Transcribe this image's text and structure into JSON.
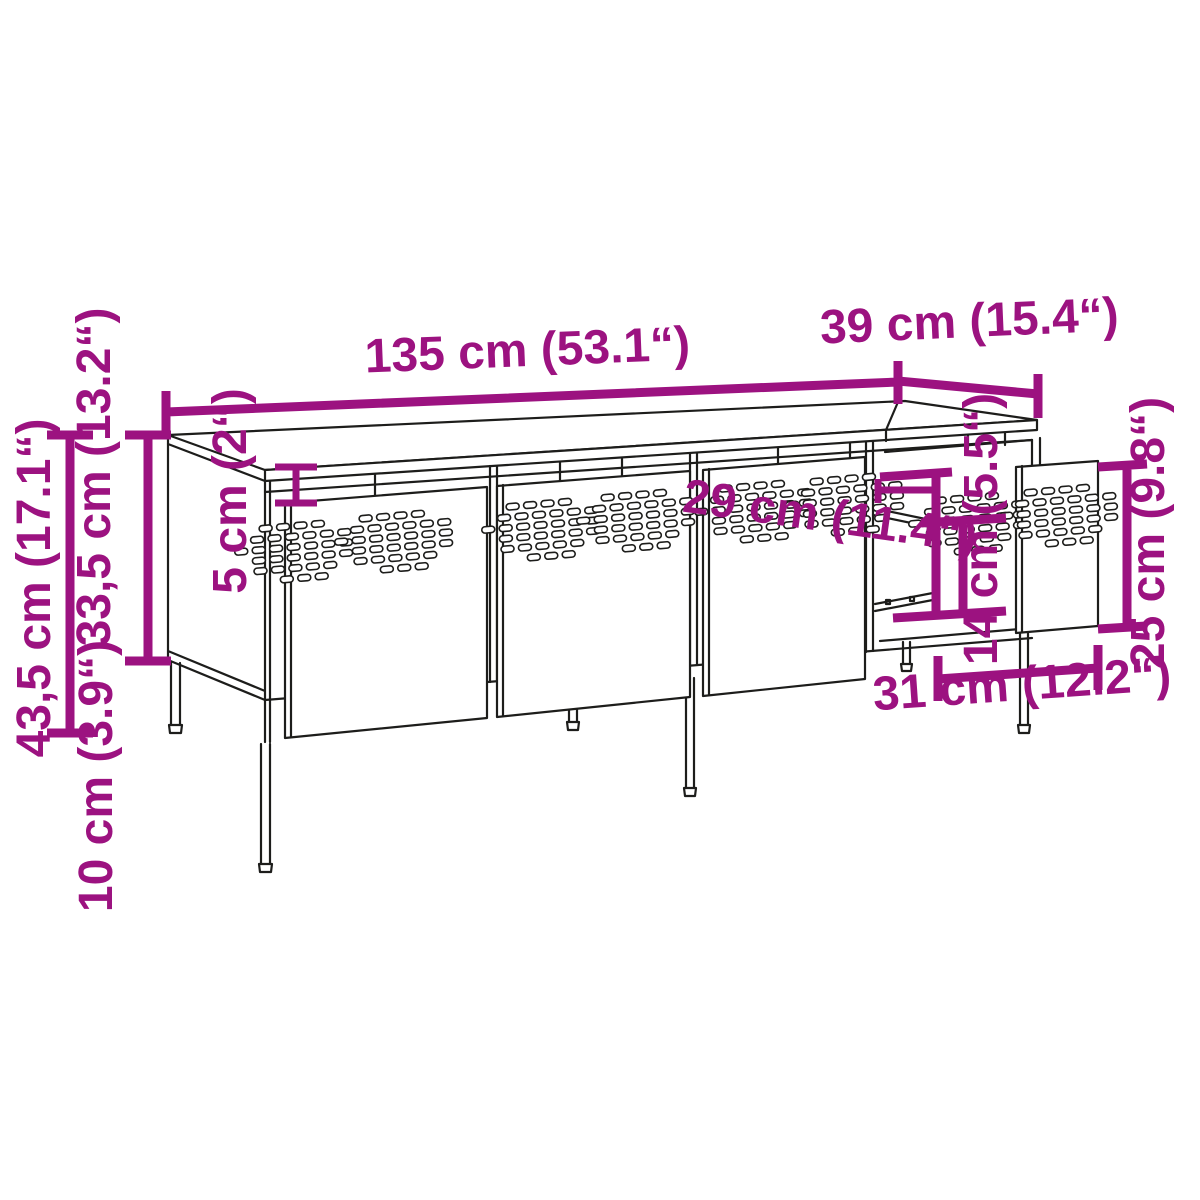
{
  "diagram": {
    "type": "furniture-dimension-diagram",
    "colors": {
      "dimension_accent": "#9C1280",
      "line": "#1D1D1B",
      "background": "#FFFFFF"
    },
    "dimensions": {
      "width": "135 cm (53.1“)",
      "depth": "39 cm (15.4“)",
      "total_height": "43,5 cm (17.1“)",
      "body_height": "33,5 cm (13.2“)",
      "leg_height": "10 cm (3.9“)",
      "top_gap": "5 cm (2“)",
      "compartment_height": "29 cm (11.4“)",
      "drawer_front_height": "14 cm (5.5“)",
      "door_height": "25 cm (9.8“)",
      "door_width": "31 cm (12.2“)"
    }
  }
}
